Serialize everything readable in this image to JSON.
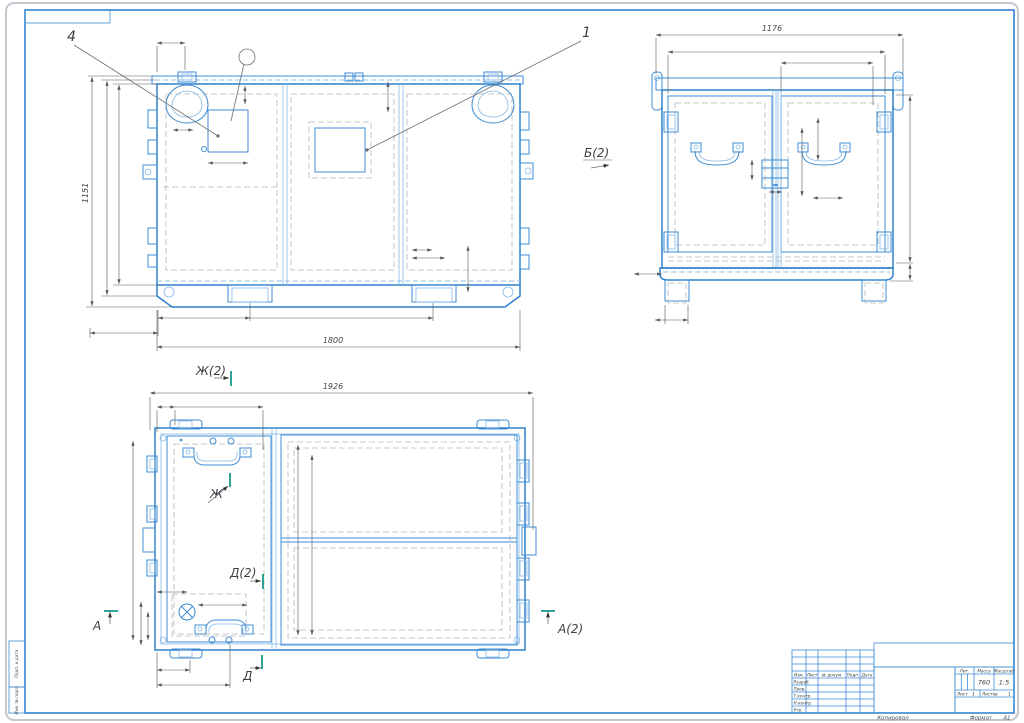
{
  "colors": {
    "line_blue": "#2f80cc",
    "line_blue_light": "#85b9e6",
    "hidden_gray": "#b3b9bf",
    "dim_gray": "#53585e",
    "section_teal": "#1a9a8e",
    "paper_edge": "#c2c9d0"
  },
  "callouts": {
    "pos1": "1",
    "pos4": "4"
  },
  "views": {
    "front": {
      "width": "1800",
      "height": "1151"
    },
    "side": {
      "label": "Б(2)",
      "width": "1176"
    },
    "plan": {
      "width": "1926",
      "section_zh2": "Ж(2)",
      "section_zh": "Ж",
      "section_d2": "Д(2)",
      "section_d": "Д",
      "section_a": "А",
      "section_a2": "А(2)"
    }
  },
  "title_block": {
    "header_cols": [
      "Изм.",
      "Лист",
      "№ докум.",
      "Подп.",
      "Дата"
    ],
    "row_labels": [
      "Разраб.",
      "Пров.",
      "Т.контр.",
      "Н.контр.",
      "Утв."
    ],
    "lit_label": "Лит.",
    "mass_label": "Масса",
    "scale_label": "Масштаб",
    "mass_value": "760",
    "scale_value": "1:5",
    "sheet_label": "Лист",
    "sheet_value": "1",
    "sheets_label": "Листов",
    "sheets_value": "1"
  },
  "sheet": {
    "copy_stamp": "Копировал",
    "format_label": "Формат",
    "format_value": "А1",
    "margin_top_label": "Подп. и дата",
    "margin_bottom_label": "Инв. № подл."
  }
}
